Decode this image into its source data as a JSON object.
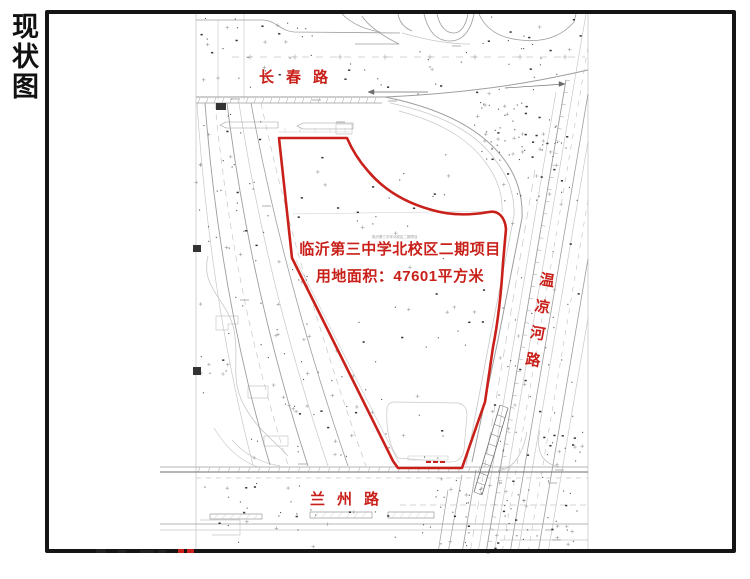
{
  "page": {
    "side_title_vertical": "现状图"
  },
  "plan": {
    "road_top": "长春路",
    "road_bottom": "兰州路",
    "road_right_vertical": "温凉河路",
    "parcel_label_line1": "临沂第三中学北校区二期项目",
    "parcel_label_line2": "用地面积：47601平方米",
    "parcel_area_sqm": "47601",
    "tiny_parcel_label": "临沂第三中学北校区二期项目",
    "colors": {
      "highlight_red": "#c9201a",
      "frame_black": "#151515",
      "line_dark": "#6e6e6e",
      "line_mid": "#9e9e9e",
      "line_light": "#c8c8c8",
      "speckle": "#555555"
    }
  }
}
